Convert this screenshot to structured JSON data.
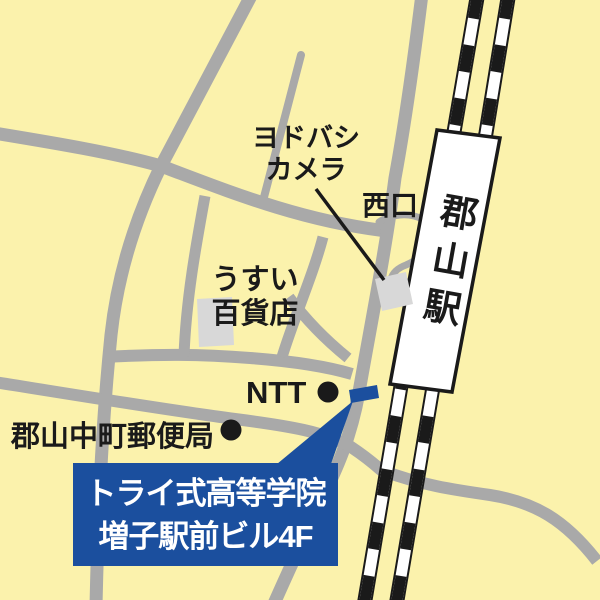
{
  "map": {
    "colors": {
      "background": "#FBF2AC",
      "road_gray": "#A9A9A9",
      "building_gray": "#D8D8D8",
      "ink_black": "#1A1A1A",
      "accent_blue": "#1B4F9E",
      "white": "#FFFFFF"
    },
    "labels": {
      "yodobashi_line1": "ヨドバシ",
      "yodobashi_line2": "カメラ",
      "west_exit": "西口",
      "station": "郡山駅",
      "usui_line1": "うすい",
      "usui_line2": "百貨店",
      "ntt": "NTT",
      "post_office": "郡山中町郵便局",
      "destination_line1": "トライ式高等学院",
      "destination_line2": "増子駅前ビル4F"
    }
  }
}
